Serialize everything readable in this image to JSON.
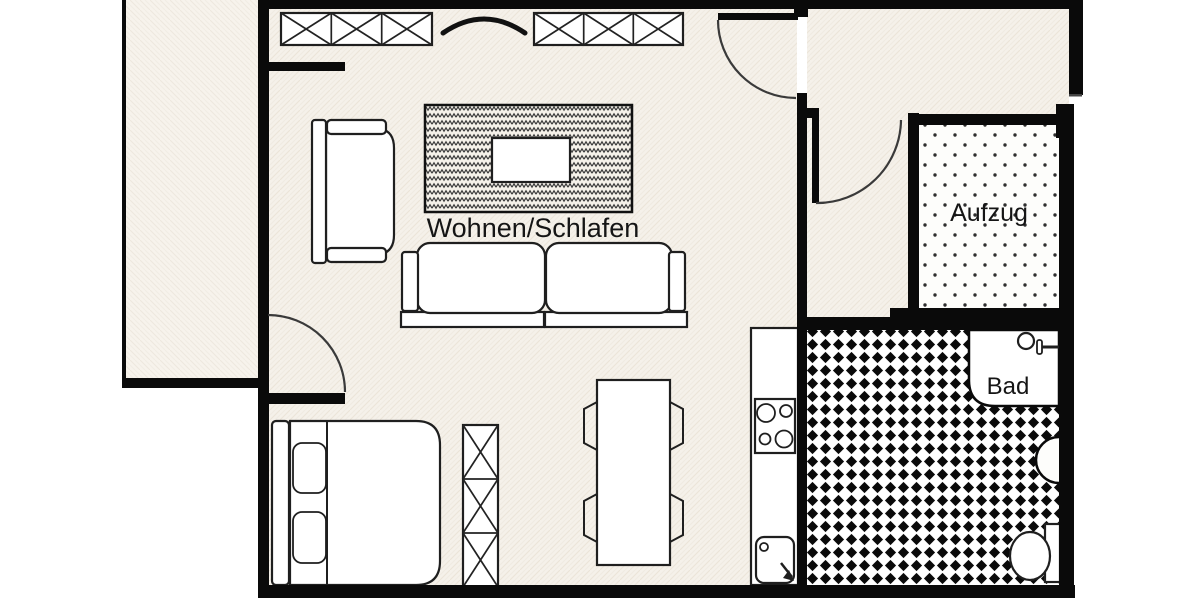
{
  "plan": {
    "rooms": {
      "living": {
        "label": "Wohnen/Schlafen"
      },
      "elevator": {
        "label": "Aufzug"
      },
      "bathroom": {
        "label": "Bad"
      }
    },
    "colors": {
      "wall": "#0a0a0a",
      "floor_base": "#f5f1ea",
      "balcony_base": "#f7f3ec",
      "bath_tile_black": "#0a0a0a",
      "elevator_dot": "#2f2f2f",
      "furniture_outline": "#1f1f1f",
      "label_text": "#151515",
      "background": "#ffffff"
    }
  }
}
